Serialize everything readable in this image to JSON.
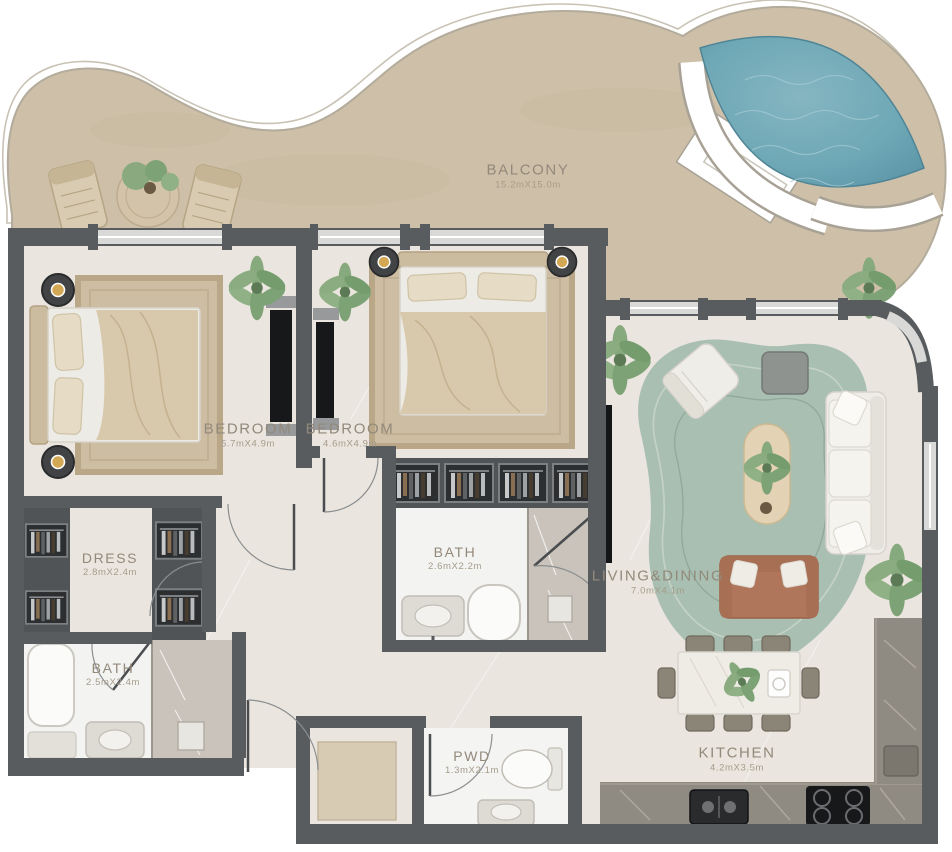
{
  "plan": {
    "type": "apartment-floor-plan",
    "rooms": [
      {
        "id": "balcony",
        "name": "BALCONY",
        "dims": "15.2mX15.0m"
      },
      {
        "id": "bedroom-1",
        "name": "BEDROOM",
        "dims": "5.7mX4.9m"
      },
      {
        "id": "bedroom-2",
        "name": "BEDROOM",
        "dims": "4.6mX4.9m"
      },
      {
        "id": "dress",
        "name": "DRESS",
        "dims": "2.8mX2.4m"
      },
      {
        "id": "bath-1",
        "name": "BATH",
        "dims": "2.5mX2.4m"
      },
      {
        "id": "bath-2",
        "name": "BATH",
        "dims": "2.6mX2.2m"
      },
      {
        "id": "pwd",
        "name": "PWD",
        "dims": "1.3mX2.1m"
      },
      {
        "id": "living-dining",
        "name": "LIVING&DINING",
        "dims": "7.0mX4.1m"
      },
      {
        "id": "kitchen",
        "name": "KITCHEN",
        "dims": "4.2mX3.5m"
      }
    ],
    "colors": {
      "walls": "#585c5f",
      "balcony_floor": "#cec0a8",
      "interior_floor": "#eae5de",
      "pool_water": "#6fa8b6",
      "rug_green": "#a9bfb1",
      "label_text": "#93897b",
      "accent_wood": "#d6c5a8"
    }
  }
}
